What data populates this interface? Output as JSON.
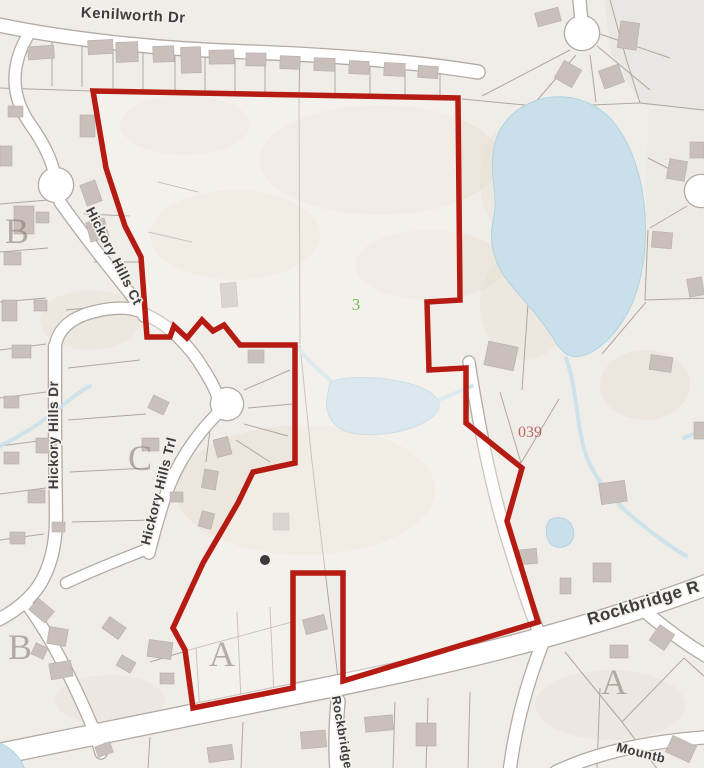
{
  "map": {
    "width": 704,
    "height": 768,
    "colors": {
      "background": "#f0ede8",
      "parcel_line": "#a29b95",
      "road_fill": "#ffffff",
      "road_casing": "#b2aaa3",
      "water": "#c9e0ea",
      "water_edge": "#b3d2e0",
      "building": "#c9c0bb",
      "building_edge": "#b6ada8",
      "boundary": "#b51a13",
      "terrain": "#e6ddcf",
      "letter_gray": "rgba(125,117,108,0.55)",
      "street_label": "#3d3d3d",
      "parcel_green": "#6cbf4f",
      "parcel_red": "#b36a66",
      "dot": "#3a3a3a"
    },
    "boundary": {
      "stroke_width": 5.5,
      "interior_fill": "rgba(252,250,246,0.35)",
      "points": [
        [
          93,
          91
        ],
        [
          458,
          98
        ],
        [
          460,
          300
        ],
        [
          427,
          302
        ],
        [
          429,
          370
        ],
        [
          466,
          368
        ],
        [
          466,
          423
        ],
        [
          522,
          468
        ],
        [
          507,
          521
        ],
        [
          538,
          622
        ],
        [
          343,
          681
        ],
        [
          343,
          573
        ],
        [
          293,
          573
        ],
        [
          293,
          688
        ],
        [
          193,
          708
        ],
        [
          185,
          650
        ],
        [
          173,
          628
        ],
        [
          203,
          563
        ],
        [
          238,
          503
        ],
        [
          253,
          472
        ],
        [
          295,
          463
        ],
        [
          295,
          345
        ],
        [
          240,
          345
        ],
        [
          224,
          325
        ],
        [
          213,
          331
        ],
        [
          202,
          320
        ],
        [
          187,
          338
        ],
        [
          174,
          326
        ],
        [
          170,
          337
        ],
        [
          147,
          337
        ],
        [
          141,
          257
        ],
        [
          125,
          226
        ],
        [
          106,
          168
        ]
      ]
    },
    "terrain_polys": [
      {
        "pts": [
          [
            604,
            0
          ],
          [
            704,
            0
          ],
          [
            704,
            112
          ],
          [
            641,
            104
          ],
          [
            612,
            56
          ]
        ],
        "fill": "#e8e6e2",
        "op": 0.9
      },
      {
        "pts": [
          [
            648,
            108
          ],
          [
            704,
            112
          ],
          [
            704,
            300
          ],
          [
            644,
            300
          ]
        ],
        "fill": "#ebe8e4",
        "op": 0.7
      }
    ],
    "terrain_ellipses": [
      [
        380,
        160,
        120,
        55,
        0.5
      ],
      [
        235,
        235,
        85,
        45,
        0.45
      ],
      [
        430,
        265,
        75,
        35,
        0.4
      ],
      [
        305,
        490,
        130,
        65,
        0.45
      ],
      [
        185,
        125,
        65,
        30,
        0.4
      ],
      [
        525,
        305,
        45,
        55,
        0.35
      ],
      [
        645,
        385,
        45,
        35,
        0.4
      ],
      [
        110,
        700,
        55,
        25,
        0.3
      ],
      [
        610,
        705,
        75,
        35,
        0.3
      ],
      [
        90,
        320,
        50,
        30,
        0.35
      ],
      [
        520,
        180,
        40,
        60,
        0.3
      ]
    ],
    "parcels": [
      [
        52,
        36,
        52,
        86
      ],
      [
        82,
        38,
        82,
        87
      ],
      [
        113,
        40,
        113,
        88
      ],
      [
        143,
        42,
        143,
        89
      ],
      [
        175,
        44,
        175,
        90
      ],
      [
        205,
        46,
        205,
        91
      ],
      [
        235,
        48,
        235,
        92
      ],
      [
        265,
        50,
        265,
        93
      ],
      [
        300,
        52,
        299,
        96
      ],
      [
        335,
        54,
        335,
        96
      ],
      [
        370,
        56,
        370,
        97
      ],
      [
        405,
        58,
        405,
        97
      ],
      [
        440,
        60,
        440,
        98
      ],
      [
        0,
        88,
        92,
        91
      ],
      [
        299,
        98,
        300,
        344
      ],
      [
        300,
        345,
        312,
        462
      ],
      [
        312,
        462,
        338,
        678
      ],
      [
        570,
        50,
        482,
        96
      ],
      [
        576,
        55,
        534,
        104
      ],
      [
        590,
        55,
        596,
        102
      ],
      [
        597,
        46,
        650,
        90
      ],
      [
        600,
        34,
        670,
        58
      ],
      [
        462,
        99,
        545,
        107
      ],
      [
        545,
        107,
        640,
        103
      ],
      [
        640,
        103,
        704,
        110
      ],
      [
        610,
        0,
        626,
        58
      ],
      [
        626,
        58,
        640,
        103
      ],
      [
        685,
        177,
        648,
        158
      ],
      [
        687,
        206,
        650,
        228
      ],
      [
        648,
        230,
        645,
        300
      ],
      [
        645,
        300,
        706,
        298
      ],
      [
        602,
        354,
        646,
        302
      ],
      [
        500,
        392,
        521,
        463
      ],
      [
        521,
        463,
        559,
        399
      ],
      [
        528,
        304,
        522,
        390
      ],
      [
        565,
        652,
        622,
        722
      ],
      [
        622,
        722,
        684,
        658
      ],
      [
        622,
        722,
        658,
        770
      ],
      [
        684,
        658,
        706,
        678
      ],
      [
        600,
        688,
        597,
        768
      ],
      [
        150,
        737,
        148,
        768
      ],
      [
        243,
        722,
        241,
        768
      ],
      [
        395,
        702,
        393,
        768
      ],
      [
        428,
        698,
        426,
        768
      ],
      [
        470,
        692,
        468,
        768
      ],
      [
        196,
        648,
        292,
        622
      ],
      [
        237,
        612,
        241,
        700
      ],
      [
        270,
        607,
        274,
        696
      ],
      [
        150,
        662,
        196,
        648
      ],
      [
        196,
        648,
        200,
        712
      ],
      [
        0,
        350,
        46,
        344
      ],
      [
        0,
        398,
        46,
        392
      ],
      [
        0,
        446,
        46,
        440
      ],
      [
        0,
        494,
        46,
        488
      ],
      [
        0,
        540,
        44,
        534
      ],
      [
        0,
        302,
        46,
        298
      ],
      [
        0,
        252,
        48,
        248
      ],
      [
        0,
        204,
        48,
        200
      ],
      [
        84,
        214,
        130,
        216
      ],
      [
        94,
        262,
        140,
        262
      ],
      [
        66,
        310,
        108,
        306
      ],
      [
        148,
        232,
        192,
        242
      ],
      [
        158,
        182,
        198,
        192
      ],
      [
        244,
        390,
        290,
        370
      ],
      [
        248,
        408,
        292,
        404
      ],
      [
        244,
        424,
        288,
        436
      ],
      [
        236,
        440,
        270,
        462
      ],
      [
        210,
        430,
        206,
        462
      ],
      [
        68,
        368,
        140,
        360
      ],
      [
        68,
        420,
        146,
        414
      ],
      [
        70,
        472,
        148,
        468
      ],
      [
        72,
        522,
        150,
        520
      ]
    ],
    "roads": [
      {
        "name": "kenilworth-dr",
        "d": "M -6,24 C 60,38 150,49 250,52 C 330,55 410,61 478,72",
        "w": 13
      },
      {
        "name": "hickory-hills-dr-upper",
        "d": "M 30,32 C 11,62 9,94 30,124 C 45,145 53,162 55,178",
        "w": 11
      },
      {
        "name": "hickory-hills-ct",
        "d": "M 60,202 C 78,228 100,256 124,286 C 133,297 140,307 144,316",
        "w": 11
      },
      {
        "name": "junction-bend",
        "d": "M 55,348 C 57,330 70,318 93,312 C 116,306 136,307 146,315",
        "w": 11
      },
      {
        "name": "trl-feeder",
        "d": "M 146,315 C 168,324 190,346 204,370 C 211,381 215,389 217,395",
        "w": 11
      },
      {
        "name": "hickory-hills-trl",
        "d": "M 218,413 C 196,435 176,464 165,497 C 157,521 152,541 149,553",
        "w": 11
      },
      {
        "name": "trl-connector",
        "d": "M 150,548 C 124,558 94,570 66,583",
        "w": 10
      },
      {
        "name": "hickory-hills-dr",
        "d": "M 55,346 L 55,430 L 56,518 C 56,547 50,569 38,587 C 28,601 14,612 -4,621",
        "w": 12
      },
      {
        "name": "dr-south-branch",
        "d": "M 28,606 C 50,636 73,681 93,728 C 97,738 99,746 101,753",
        "w": 11
      },
      {
        "name": "east-parcel-road",
        "d": "M 469,362 C 478,420 492,492 510,548 C 520,580 531,615 543,642",
        "w": 11
      },
      {
        "name": "south-branch",
        "d": "M 543,642 C 528,680 516,722 510,768",
        "w": 12
      },
      {
        "name": "southeast-branch",
        "d": "M 648,614 C 672,634 692,648 710,658",
        "w": 12
      },
      {
        "name": "mountbatten-road",
        "d": "M 556,772 C 598,752 650,741 710,737",
        "w": 12
      },
      {
        "name": "culdesac-stem",
        "d": "M 579,-4 L 581,16",
        "w": 12
      },
      {
        "name": "rockbridge-rd",
        "d": "M -6,755 C 90,735 200,713 310,691 C 430,667 565,638 712,583",
        "w": 20
      },
      {
        "name": "rockbridge-branch",
        "d": "M 338,701 C 336,724 335,746 337,770",
        "w": 13
      }
    ],
    "culdesacs": [
      [
        56,
        185,
        17
      ],
      [
        227,
        404,
        16
      ],
      [
        582,
        33,
        17
      ],
      [
        701,
        191,
        16
      ]
    ],
    "water_polys": [
      {
        "name": "large-pond",
        "d": "M 545,98 C 515,105 496,125 493,154 C 490,180 499,198 493,221 C 488,245 496,268 511,285 C 523,300 541,318 553,338 C 561,352 569,359 581,356 C 601,351 619,331 631,306 C 643,279 647,248 645,215 C 643,180 633,148 616,125 C 599,103 572,93 545,98 Z"
      },
      {
        "name": "middle-pond",
        "d": "M 330,382 C 345,376 372,376 398,381 C 420,385 436,393 439,403 C 441,413 428,423 408,429 C 385,436 356,437 341,429 C 329,422 325,410 327,398 C 328,392 329,386 330,382 Z"
      },
      {
        "name": "small-pond",
        "d": "M 548,522 C 553,516 566,516 571,524 C 576,532 574,542 566,546 C 557,550 549,545 547,537 C 546,531 546,526 548,522 Z"
      },
      {
        "name": "corner-pool",
        "d": "M -2,742 C 10,747 20,755 25,770 L -2,770 Z"
      }
    ],
    "creeks": [
      "M -4,448 C 22,436 45,420 62,406 C 74,396 82,390 90,386",
      "M 298,348 C 308,360 318,370 330,380",
      "M 438,400 C 452,395 462,390 472,386",
      "M 566,358 C 578,392 576,425 586,455 C 596,482 615,502 636,520 C 652,533 668,545 686,556",
      "M 684,438 C 692,434 700,432 708,430"
    ],
    "buildings": [
      [
        28,
        46,
        26,
        13,
        -4
      ],
      [
        88,
        40,
        25,
        14,
        -3
      ],
      [
        116,
        42,
        22,
        20,
        -2
      ],
      [
        153,
        46,
        21,
        16,
        -2
      ],
      [
        181,
        47,
        20,
        26,
        -2
      ],
      [
        209,
        50,
        25,
        14,
        -1
      ],
      [
        246,
        53,
        20,
        13,
        1
      ],
      [
        280,
        56,
        20,
        13,
        2
      ],
      [
        314,
        58,
        21,
        13,
        2
      ],
      [
        349,
        61,
        20,
        13,
        3
      ],
      [
        384,
        63,
        21,
        13,
        3
      ],
      [
        418,
        66,
        20,
        12,
        4
      ],
      [
        536,
        10,
        24,
        14,
        -15
      ],
      [
        619,
        22,
        19,
        27,
        8
      ],
      [
        558,
        64,
        20,
        20,
        30
      ],
      [
        601,
        67,
        21,
        19,
        -20
      ],
      [
        668,
        160,
        18,
        20,
        10
      ],
      [
        690,
        142,
        14,
        16,
        0
      ],
      [
        652,
        232,
        20,
        16,
        5
      ],
      [
        688,
        278,
        15,
        18,
        -10
      ],
      [
        650,
        356,
        22,
        15,
        8
      ],
      [
        694,
        422,
        13,
        17,
        0
      ],
      [
        486,
        344,
        30,
        24,
        12
      ],
      [
        600,
        482,
        26,
        21,
        -8
      ],
      [
        520,
        549,
        17,
        15,
        -5
      ],
      [
        593,
        563,
        18,
        19,
        0
      ],
      [
        560,
        578,
        11,
        16,
        0
      ],
      [
        653,
        628,
        18,
        19,
        35
      ],
      [
        610,
        645,
        18,
        13,
        0
      ],
      [
        8,
        106,
        15,
        11,
        0
      ],
      [
        0,
        146,
        12,
        20,
        0
      ],
      [
        14,
        206,
        20,
        28,
        0
      ],
      [
        36,
        212,
        13,
        11,
        0
      ],
      [
        4,
        252,
        17,
        13,
        0
      ],
      [
        2,
        300,
        15,
        21,
        0
      ],
      [
        34,
        300,
        13,
        11,
        0
      ],
      [
        12,
        345,
        19,
        13,
        0
      ],
      [
        4,
        396,
        15,
        12,
        0
      ],
      [
        36,
        438,
        21,
        15,
        0
      ],
      [
        4,
        452,
        15,
        12,
        0
      ],
      [
        28,
        490,
        17,
        13,
        0
      ],
      [
        10,
        532,
        15,
        12,
        0
      ],
      [
        52,
        522,
        13,
        10,
        0
      ],
      [
        80,
        115,
        15,
        22,
        0
      ],
      [
        83,
        182,
        16,
        22,
        -20
      ],
      [
        88,
        220,
        19,
        20,
        -15
      ],
      [
        221,
        283,
        16,
        24,
        -5
      ],
      [
        248,
        350,
        16,
        13,
        0
      ],
      [
        150,
        398,
        17,
        14,
        25
      ],
      [
        142,
        438,
        17,
        13,
        0
      ],
      [
        215,
        438,
        15,
        18,
        -15
      ],
      [
        203,
        470,
        14,
        19,
        10
      ],
      [
        170,
        492,
        13,
        10,
        0
      ],
      [
        200,
        512,
        13,
        16,
        15
      ],
      [
        273,
        513,
        16,
        17,
        0
      ],
      [
        31,
        603,
        21,
        15,
        40
      ],
      [
        48,
        628,
        19,
        17,
        10
      ],
      [
        33,
        645,
        13,
        12,
        25
      ],
      [
        50,
        662,
        22,
        16,
        -10
      ],
      [
        104,
        621,
        20,
        14,
        35
      ],
      [
        148,
        641,
        24,
        17,
        8
      ],
      [
        118,
        658,
        16,
        12,
        30
      ],
      [
        160,
        673,
        14,
        11,
        0
      ],
      [
        304,
        617,
        22,
        15,
        -15
      ],
      [
        301,
        731,
        25,
        17,
        -5
      ],
      [
        365,
        716,
        28,
        15,
        -5
      ],
      [
        416,
        723,
        20,
        23,
        0
      ],
      [
        208,
        746,
        25,
        15,
        -8
      ],
      [
        96,
        744,
        16,
        11,
        -20
      ],
      [
        668,
        740,
        26,
        18,
        25
      ]
    ],
    "section_letters": [
      {
        "text": "B",
        "x": 17,
        "y": 243,
        "size": 36
      },
      {
        "text": "C",
        "x": 140,
        "y": 470,
        "size": 36
      },
      {
        "text": "B",
        "x": 20,
        "y": 659,
        "size": 36
      },
      {
        "text": "A",
        "x": 222,
        "y": 666,
        "size": 36
      },
      {
        "text": "A",
        "x": 614,
        "y": 694,
        "size": 36
      }
    ],
    "parcel_numbers": [
      {
        "text": "3",
        "x": 356,
        "y": 310,
        "size": 17,
        "color": "#6cbf4f"
      },
      {
        "text": "039",
        "x": 530,
        "y": 437,
        "size": 16,
        "color": "#b36a66"
      }
    ],
    "street_labels": [
      {
        "text": "Kenilworth Dr",
        "x": 133,
        "y": 20,
        "rot": 3,
        "size": 15
      },
      {
        "text": "Hickory Hills Ct",
        "x": 110,
        "y": 258,
        "rot": 63,
        "size": 13.5
      },
      {
        "text": "Hickory Hills Dr",
        "x": 58,
        "y": 435,
        "rot": -90,
        "size": 13.5
      },
      {
        "text": "Hickory Hills Trl",
        "x": 163,
        "y": 492,
        "rot": -76,
        "size": 13.5
      },
      {
        "text": "Rockbridge R",
        "x": 645,
        "y": 608,
        "rot": -17,
        "size": 17
      },
      {
        "text": "Rockbridge",
        "x": 338,
        "y": 733,
        "rot": 80,
        "size": 12.5
      },
      {
        "text": "Mountb",
        "x": 640,
        "y": 757,
        "rot": 14,
        "size": 13
      }
    ],
    "markers": [
      {
        "name": "site-dot",
        "x": 265,
        "y": 560,
        "r": 5
      }
    ]
  }
}
